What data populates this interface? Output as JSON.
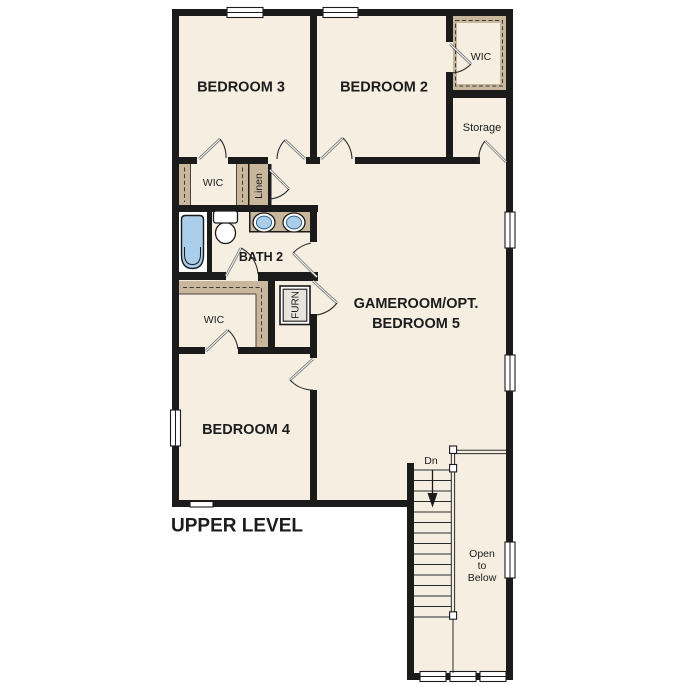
{
  "plan": {
    "title": "UPPER LEVEL",
    "rooms": {
      "bedroom3": "BEDROOM 3",
      "bedroom2": "BEDROOM 2",
      "bedroom4": "BEDROOM 4",
      "gameroom_line1": "GAMEROOM/OPT.",
      "gameroom_line2": "BEDROOM 5",
      "bath2": "BATH 2"
    },
    "closets": {
      "wic_upper_right": "WIC",
      "wic_hall": "WIC",
      "wic_bedroom4": "WIC",
      "linen": "Linen",
      "storage": "Storage",
      "furnace": "FURN"
    },
    "stairs": {
      "direction": "Dn",
      "open_below": [
        "Open",
        "to",
        "Below"
      ],
      "tread_count": 15
    },
    "colors": {
      "floor": "#f5eee1",
      "closet_band": "#c8b69d",
      "wall": "#1b1b1b",
      "fixture_blue": "#aacdea",
      "furnace_fill": "#e7e4dd",
      "text": "#1c1c1c"
    }
  }
}
